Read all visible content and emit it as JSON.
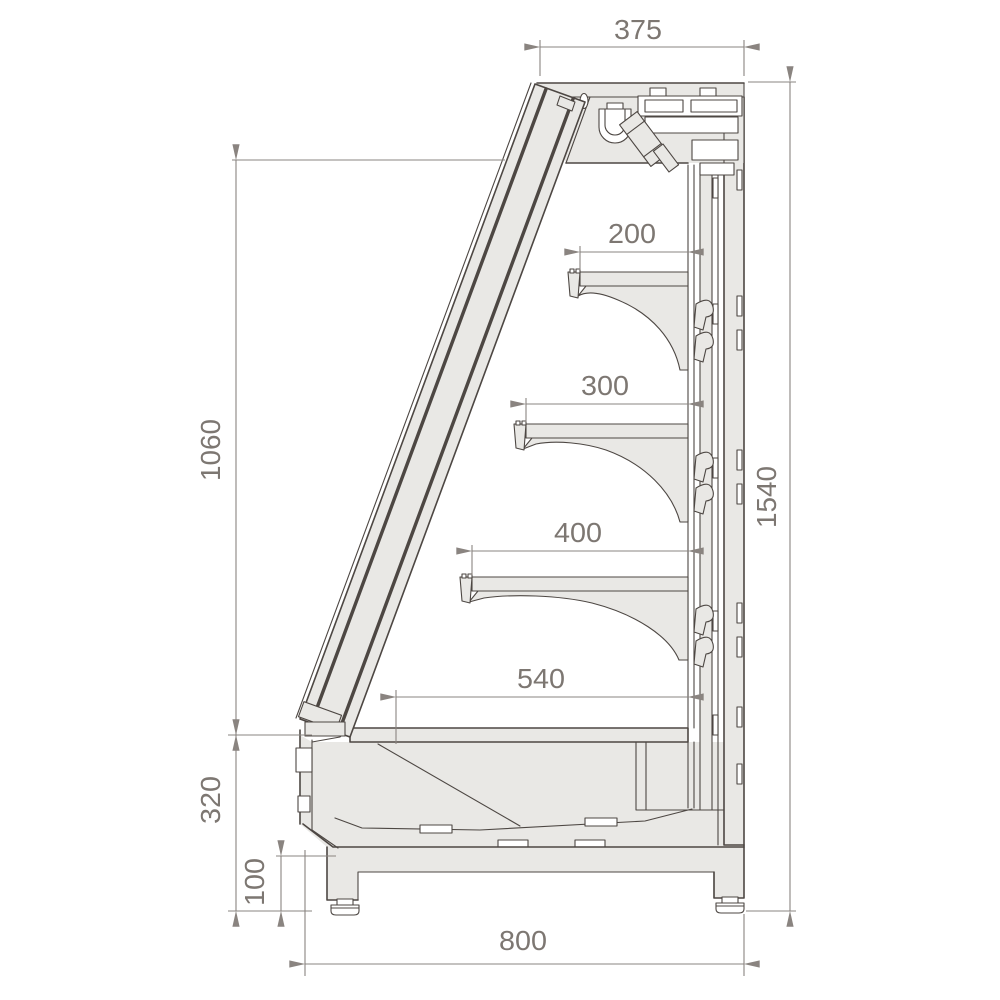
{
  "page": {
    "background": "#ffffff",
    "description": "Technical cross-section drawing of a refrigerated wall display case with shelf depths and overall dimensions"
  },
  "drawing": {
    "colors": {
      "outline": "#4d4743",
      "panel_fill": "#e9e8e5",
      "dimension_line": "#8a8480",
      "dimension_text": "#7d7772"
    },
    "dimensions": {
      "canopy_depth": "375",
      "overall_height": "1540",
      "display_opening_height": "1060",
      "base_height": "320",
      "foot_height": "100",
      "overall_depth": "800",
      "shelf_top_depth": "200",
      "shelf_middle_depth": "300",
      "shelf_bottom_depth": "400",
      "base_deck_depth": "540"
    }
  }
}
